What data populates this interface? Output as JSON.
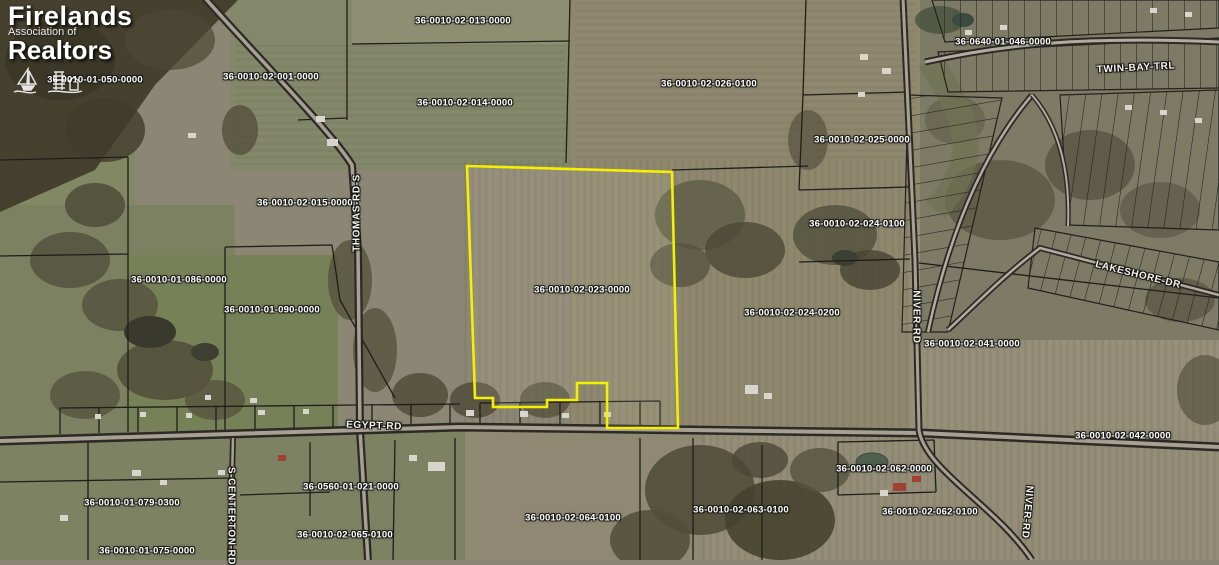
{
  "branding": {
    "name": "Firelands Association of Realtors",
    "line1": "Firelands",
    "line2": "Association of",
    "line3": "Realtors"
  },
  "map": {
    "selected_parcel_id": "36-0010-02-023-0000",
    "highlight_color": "#f4f000",
    "highlight_polygon": "467,166 672,172 678,428 607,428 607,383 577,383 577,400 547,400 547,407 493,407 493,398 475,398",
    "parcel_labels": [
      {
        "text": "36-0010-01-050-0000",
        "x": 95,
        "y": 80
      },
      {
        "text": "36-0010-02-001-0000",
        "x": 271,
        "y": 77
      },
      {
        "text": "36-0010-02-013-0000",
        "x": 463,
        "y": 21
      },
      {
        "text": "36-0010-02-014-0000",
        "x": 465,
        "y": 103
      },
      {
        "text": "36-0010-02-026-0100",
        "x": 709,
        "y": 84
      },
      {
        "text": "36-0640-01-046-0000",
        "x": 1003,
        "y": 42
      },
      {
        "text": "36-0010-02-025-0000",
        "x": 862,
        "y": 140
      },
      {
        "text": "36-0010-02-015-0000",
        "x": 305,
        "y": 203
      },
      {
        "text": "36-0010-02-024-0100",
        "x": 857,
        "y": 224
      },
      {
        "text": "36-0010-01-086-0000",
        "x": 179,
        "y": 280
      },
      {
        "text": "36-0010-01-090-0000",
        "x": 272,
        "y": 310
      },
      {
        "text": "36-0010-02-023-0000",
        "x": 582,
        "y": 290
      },
      {
        "text": "36-0010-02-024-0200",
        "x": 792,
        "y": 313
      },
      {
        "text": "36-0010-02-041-0000",
        "x": 972,
        "y": 344
      },
      {
        "text": "36-0010-02-042-0000",
        "x": 1123,
        "y": 436
      },
      {
        "text": "36-0010-02-062-0000",
        "x": 884,
        "y": 469
      },
      {
        "text": "36-0010-02-062-0100",
        "x": 930,
        "y": 512
      },
      {
        "text": "36-0010-01-079-0300",
        "x": 132,
        "y": 503
      },
      {
        "text": "36-0560-01-021-0000",
        "x": 351,
        "y": 487
      },
      {
        "text": "36-0010-02-064-0100",
        "x": 573,
        "y": 518
      },
      {
        "text": "36-0010-02-063-0100",
        "x": 741,
        "y": 510
      },
      {
        "text": "36-0010-02-065-0100",
        "x": 345,
        "y": 535
      },
      {
        "text": "36-0010-01-075-0000",
        "x": 147,
        "y": 551
      }
    ],
    "road_labels": [
      {
        "text": "THOMAS-RD-S",
        "x": 357,
        "y": 213,
        "rotate": -90
      },
      {
        "text": "EGYPT-RD",
        "x": 374,
        "y": 426,
        "rotate": 2
      },
      {
        "text": "NIVER-RD",
        "x": 916,
        "y": 317,
        "rotate": 90
      },
      {
        "text": "NIVER-RD",
        "x": 1027,
        "y": 512,
        "rotate": 95
      },
      {
        "text": "TWIN-BAY-TRL",
        "x": 1136,
        "y": 68,
        "rotate": -3
      },
      {
        "text": "LAKESHORE-DR",
        "x": 1138,
        "y": 275,
        "rotate": 14
      },
      {
        "text": "S-CENTERTON-RD",
        "x": 231,
        "y": 516,
        "rotate": 90
      }
    ]
  }
}
